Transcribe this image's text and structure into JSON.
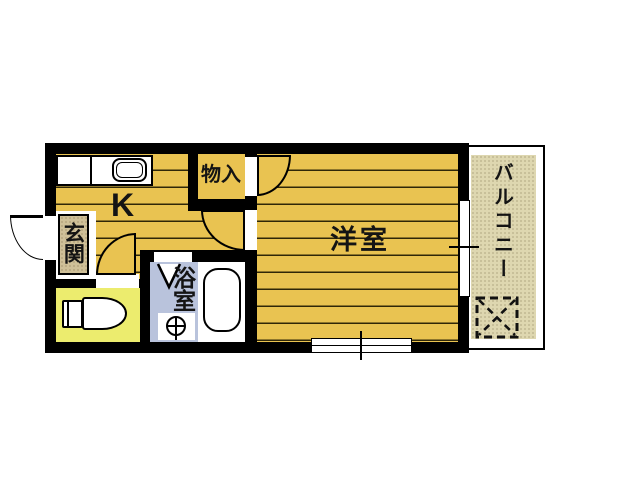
{
  "labels": {
    "kitchen": "K",
    "closet": "物入",
    "entrance": "玄関",
    "western_room": "洋室",
    "bathroom": "浴室",
    "balcony": "バルコニー"
  },
  "colors": {
    "wall": "#000000",
    "wood_floor": "#e9c351",
    "floor_line": "#2f2708",
    "toilet_room": "#ecec6e",
    "bathroom_floor": "#b9c3dc",
    "entrance_mat": "#cfc098",
    "balcony_floor": "#ded7b0",
    "fixture": "#ffffff"
  }
}
